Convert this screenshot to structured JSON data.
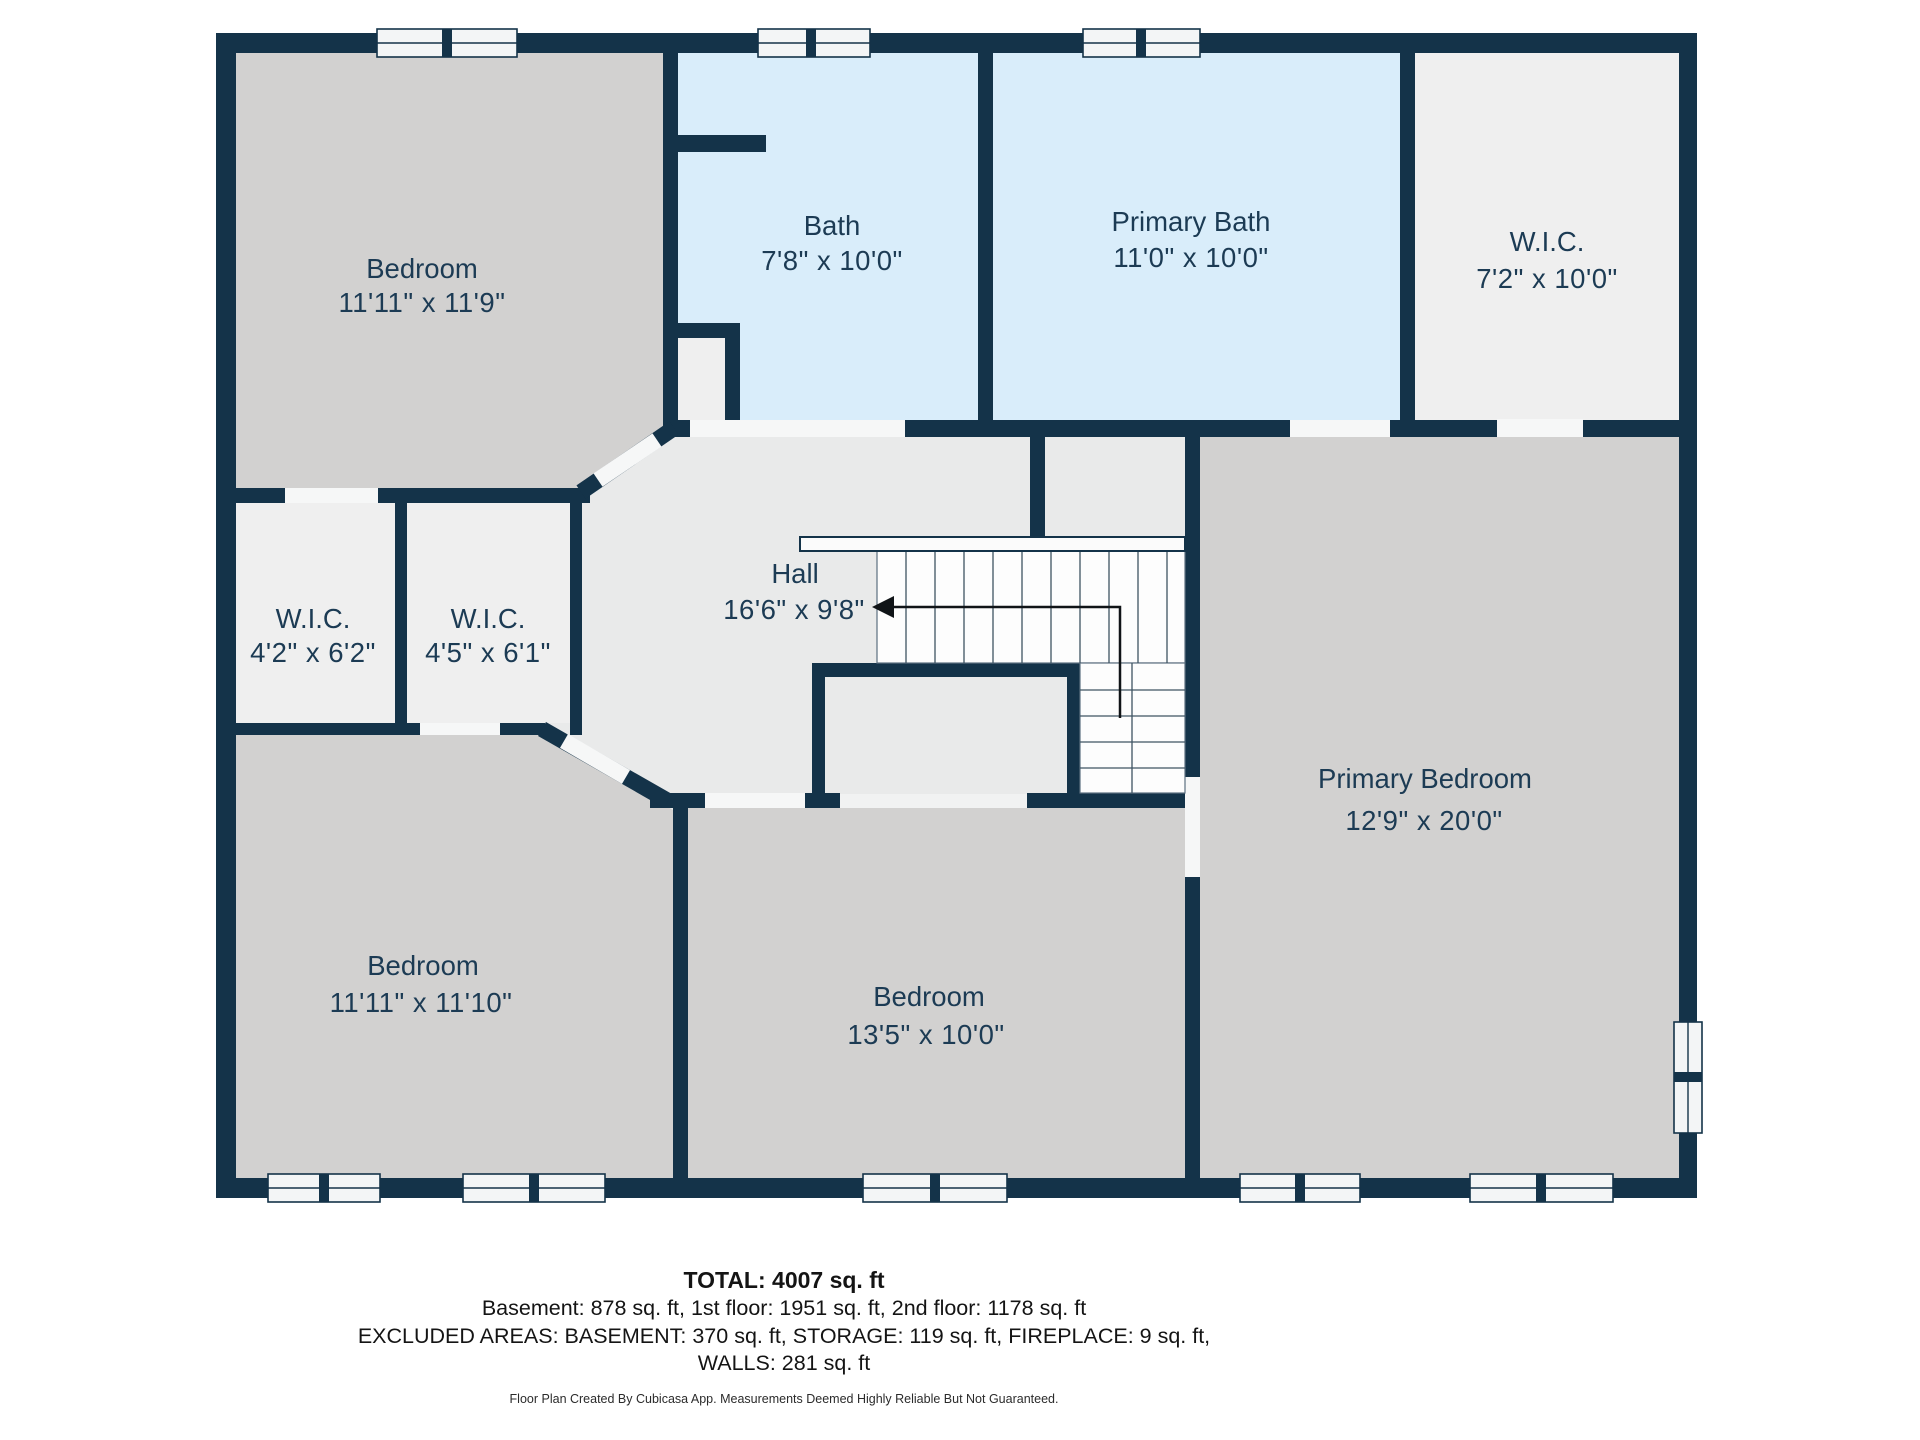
{
  "plan": {
    "rooms": [
      {
        "key": "bedroom-top-left",
        "name": "Bedroom",
        "dims": "11'11\" x 11'9\""
      },
      {
        "key": "bath",
        "name": "Bath",
        "dims": "7'8\" x 10'0\""
      },
      {
        "key": "primary-bath",
        "name": "Primary Bath",
        "dims": "11'0\" x 10'0\""
      },
      {
        "key": "wic-top-right",
        "name": "W.I.C.",
        "dims": "7'2\" x 10'0\""
      },
      {
        "key": "wic-left-1",
        "name": "W.I.C.",
        "dims": "4'2\" x 6'2\""
      },
      {
        "key": "wic-left-2",
        "name": "W.I.C.",
        "dims": "4'5\" x 6'1\""
      },
      {
        "key": "hall",
        "name": "Hall",
        "dims": "16'6\" x 9'8\""
      },
      {
        "key": "bedroom-bottom-left",
        "name": "Bedroom",
        "dims": "11'11\" x 11'10\""
      },
      {
        "key": "bedroom-bottom-middle",
        "name": "Bedroom",
        "dims": "13'5\" x 10'0\""
      },
      {
        "key": "primary-bedroom",
        "name": "Primary Bedroom",
        "dims": "12'9\" x 20'0\""
      }
    ]
  },
  "summary": {
    "total": "TOTAL: 4007 sq. ft",
    "line2": "Basement: 878 sq. ft, 1st floor: 1951 sq. ft, 2nd floor: 1178 sq. ft",
    "line3": "EXCLUDED AREAS: BASEMENT: 370 sq. ft, STORAGE: 119 sq. ft, FIREPLACE: 9 sq. ft,",
    "line4": "WALLS: 281 sq. ft"
  },
  "footer": "Floor Plan Created By Cubicasa App. Measurements Deemed Highly Reliable But Not Guaranteed.",
  "colors": {
    "wall": "#143349",
    "bedroom_fill": "#d2d1d0",
    "bath_fill": "#d9edfa",
    "closet_fill": "#efefef",
    "hall_fill": "#e9eaea",
    "door_gap": "#f6f7f7",
    "window_fill": "#f3f5f6",
    "label_text": "#1c3b54",
    "stair_tread_line": "#3f5463"
  }
}
